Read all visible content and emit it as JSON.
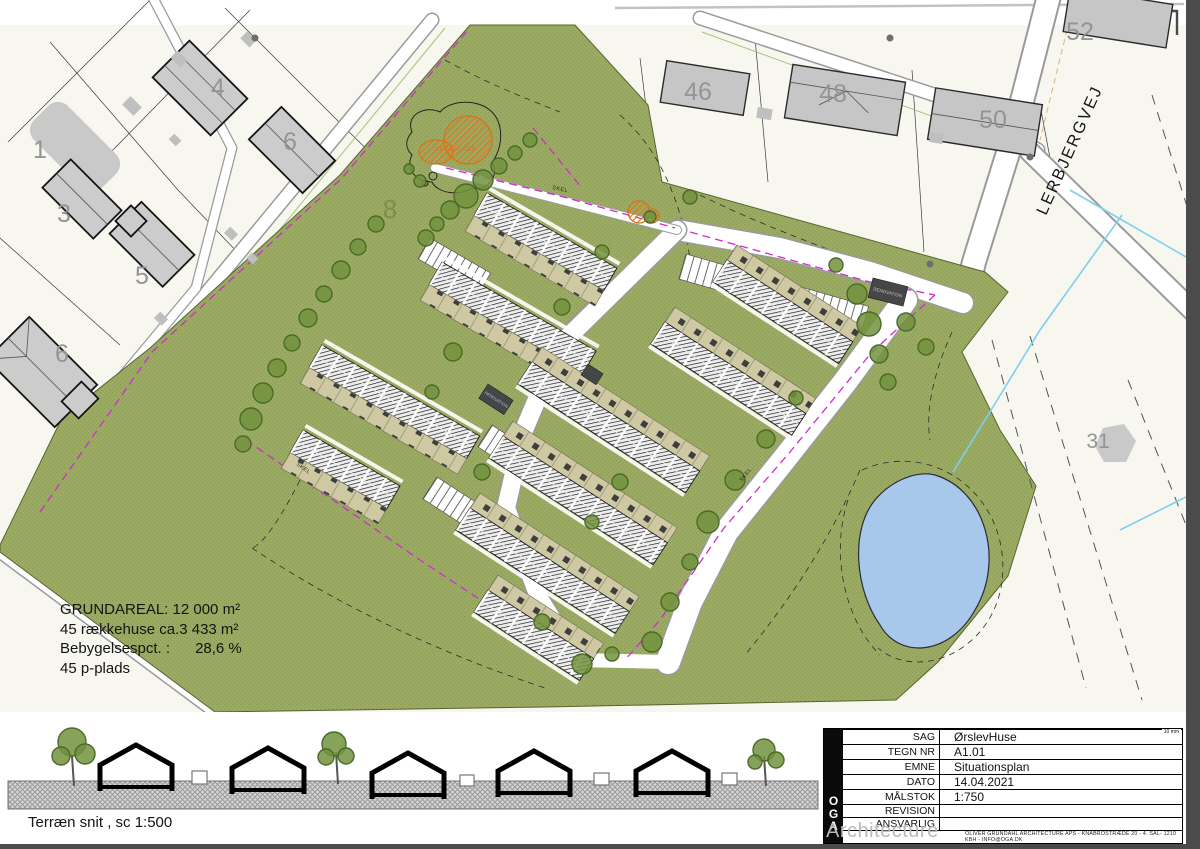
{
  "map": {
    "street": "LERBJERGVEJ",
    "area_number": "8",
    "playground": "LEGEPLADS",
    "skel": "SKEL",
    "renovation": "RENOVATION",
    "parcels": {
      "n1": "1",
      "n3": "3",
      "n4": "4",
      "n5": "5",
      "n6": "6",
      "n6b": "6",
      "n31": "31",
      "n46": "46",
      "n48": "48",
      "n50": "50",
      "n52": "52"
    },
    "stats": {
      "line1": "GRUNDAREAL: 12 000 m²",
      "line2": "45 rækkehuse ca.3 433 m²",
      "line3": "Bebygelsespct. :      28,6 %",
      "line4": "45 p-plads"
    }
  },
  "section": {
    "caption": "Terræn snit , sc 1:500"
  },
  "titleblock": {
    "ruler_label": "10 mm",
    "logo_letters": [
      "O",
      "G",
      "A"
    ],
    "logo_word": "Architecture",
    "rows": [
      {
        "label": "SAG",
        "value": "ØrslevHuse"
      },
      {
        "label": "TEGN NR",
        "value": "A1.01"
      },
      {
        "label": "EMNE",
        "value": "Situationsplan"
      },
      {
        "label": "DATO",
        "value": "14.04.2021"
      },
      {
        "label": "MÅLSTOK",
        "value": "1:750"
      },
      {
        "label": "REVISION",
        "value": ""
      },
      {
        "label": "ANSVARLIG",
        "value": ""
      }
    ],
    "footer": "OLIVER GRUNDAHL ARCHITECTURE APS - KNABROSTRÆDE 20 - 4. SAL- 1210 KBH - INFO@OGA.DK"
  },
  "colors": {
    "site_green": "#9cab64",
    "pond_blue": "#a8c8eb",
    "boundary_magenta": "#cf2bcf",
    "playground_orange": "#d9731a",
    "building_gray": "#c9c9c9"
  }
}
